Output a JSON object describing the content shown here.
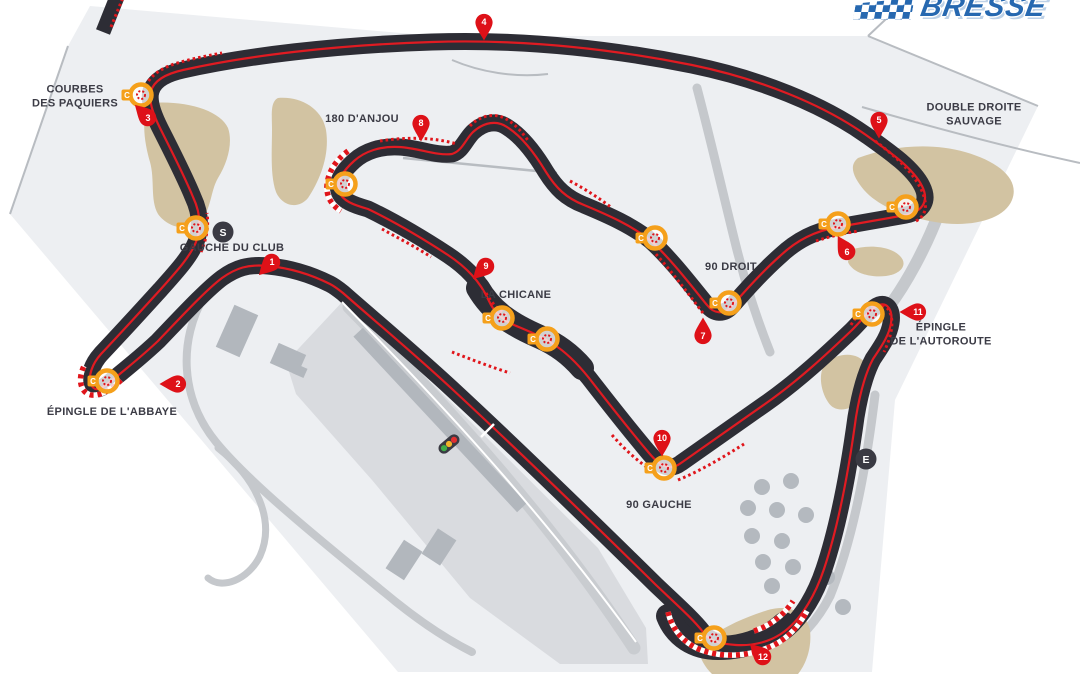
{
  "logo": {
    "text": "BRESSE",
    "color": "#2668b0"
  },
  "map": {
    "colors": {
      "panel": "#edeff2",
      "paddock": "#d9dbdf",
      "pitlane": "#c9ccd0",
      "road": "#c5c8cc",
      "thin_line": "#b8bcc1",
      "building": "#b2b7bd",
      "gravel": "#d2c3a2",
      "tree": "#b4b9bf",
      "track": "#2d2d35",
      "race_line": "#e01b22",
      "kerb_red": "#e0151b",
      "pin_red": "#de1118",
      "corner_orange": "#f5a01b",
      "marker_dark": "#3a3a43",
      "label": "#3b3b45",
      "white": "#ffffff"
    },
    "panel": {
      "points": "90,6 435,36 868,36 1038,106 895,400 872,672 398,672 10,214 68,46"
    },
    "boundary_lines": [
      {
        "d": "M868,36 L1038,106"
      },
      {
        "d": "M903,3 L868,36"
      },
      {
        "d": "M68,46 L10,214"
      },
      {
        "d": "M862,107 C935,128 1010,148 1080,163"
      },
      {
        "d": "M452,60 C480,72 515,78 548,74"
      }
    ],
    "areas": [
      {
        "points": "286,362 344,300 374,326 598,548 646,628 648,664 560,664 470,598 372,480 296,394"
      }
    ],
    "roads": [
      {
        "d": "M205,295 C178,340 180,398 216,442 C252,486 330,548 396,602 C426,626 452,642 472,652",
        "w": 8
      },
      {
        "d": "M218,448 C256,478 276,520 260,556 C248,580 222,590 208,578",
        "w": 7
      },
      {
        "d": "M697,88 C712,145 724,198 736,246 C746,286 758,322 770,352",
        "w": 9
      },
      {
        "d": "M940,210 C926,248 906,284 888,308",
        "w": 12
      },
      {
        "d": "M875,395 C868,452 856,532 830,596 C818,620 800,640 778,653",
        "w": 9
      }
    ],
    "pit_lane": {
      "d": "M349,307 C430,390 540,505 634,648",
      "w": 13
    },
    "pit_wall": {
      "d": "M342,302 C420,382 532,498 636,642",
      "w": 2
    },
    "buildings": [
      {
        "x": 237,
        "y": 331,
        "w": 26,
        "h": 46,
        "rot": 24
      },
      {
        "x": 288,
        "y": 359,
        "w": 30,
        "h": 22,
        "rot": 24
      },
      {
        "x": 300,
        "y": 371,
        "w": 12,
        "h": 10,
        "rot": 24
      },
      {
        "x": 404,
        "y": 560,
        "w": 22,
        "h": 34,
        "rot": 33
      },
      {
        "x": 439,
        "y": 547,
        "w": 22,
        "h": 30,
        "rot": 33
      },
      {
        "x": 440,
        "y": 420,
        "w": 240,
        "h": 13,
        "rot": 47
      }
    ],
    "gravel": [
      {
        "d": "M150,103 C185,100 220,110 228,128 C233,142 228,162 218,178 C210,192 212,208 200,222 C188,232 168,228 158,214 C150,200 155,180 150,162 C145,145 140,118 150,103 Z"
      },
      {
        "d": "M278,98 C300,96 322,108 326,130 C330,155 320,180 308,198 C298,210 282,206 276,192 C270,175 272,150 272,130 C272,115 270,102 278,98 Z"
      },
      {
        "d": "M858,158 C890,146 930,142 965,152 C1000,162 1020,180 1012,200 C1004,220 970,228 935,222 C905,217 878,206 864,190 C854,178 848,166 858,158 Z"
      },
      {
        "d": "M850,250 C868,244 890,246 900,256 C908,264 902,274 886,276 C868,278 852,272 848,262 Z"
      },
      {
        "d": "M826,362 C840,352 858,352 866,364 C872,374 868,390 858,402 C848,412 834,412 828,402 C820,390 818,372 826,362 Z"
      },
      {
        "d": "M700,646 C716,630 742,618 768,610 C790,604 806,612 810,630 C812,648 806,664 798,674 L712,674 C704,666 698,656 700,646 Z"
      }
    ],
    "trees": [
      {
        "x": 762,
        "y": 487
      },
      {
        "x": 791,
        "y": 481
      },
      {
        "x": 748,
        "y": 508
      },
      {
        "x": 777,
        "y": 510
      },
      {
        "x": 806,
        "y": 515
      },
      {
        "x": 752,
        "y": 536
      },
      {
        "x": 782,
        "y": 541
      },
      {
        "x": 763,
        "y": 562
      },
      {
        "x": 793,
        "y": 567
      },
      {
        "x": 772,
        "y": 586
      },
      {
        "x": 827,
        "y": 577
      },
      {
        "x": 843,
        "y": 607
      }
    ],
    "bypass": {
      "d": "M403,158 C455,163 510,168 557,173"
    },
    "stub": {
      "d": "M103,32 L119,-8"
    },
    "track": {
      "w": 17,
      "d": "M330,284 C310,274 290,268 268,266 C248,264 236,268 222,278 C206,290 182,316 158,341 C140,358 122,372 110,382 C100,390 94,392 91,384 C88,376 92,364 101,354 C118,336 140,312 160,290 C176,272 190,257 196,242 C201,229 201,214 193,197 C184,175 170,148 160,128 C154,116 148,101 151,91 C154,81 165,74 183,70 C245,56 335,45 432,42 C522,39 612,49 692,65 C760,79 822,104 866,135 C890,152 913,168 922,186 C929,200 924,211 906,215 C884,219 860,223 838,227 C815,231 797,240 780,256 C762,272 744,292 732,306 C724,315 714,314 707,305 C693,288 671,259 651,241 C633,226 608,215 584,205 C566,198 556,188 546,172 C537,157 523,137 507,127 C497,120 484,122 473,132 C465,140 462,151 452,154 C436,156 419,148 399,147 C381,146 365,151 354,161 C343,171 336,181 339,191 C342,201 354,205 368,209 C393,221 422,238 448,255 C466,267 480,281 489,301 C494,312 503,320 514,325 C528,331 541,336 553,344 C566,352 577,363 589,378 C606,400 628,428 649,453 C659,465 669,472 681,463 C701,449 732,427 765,404 C798,381 829,352 852,330 C862,320 871,308 879,305 C888,302 893,311 891,323 C889,336 881,347 873,359 C866,372 860,393 856,417 C850,461 840,521 824,569 C816,593 803,617 785,631 C771,642 753,646 736,645 C721,644 709,641 703,632 C693,619 676,604 656,585 C598,528 519,451 451,388 C411,351 369,316 343,293 C338,289 334,286 330,284 Z",
      "widen": [
        "M478,288 C492,312 512,325 540,337 C556,344 570,354 582,368",
        "M668,616 C676,636 694,648 718,648 C744,648 766,640 784,624"
      ]
    },
    "kerbs": [
      {
        "d": "M146,86 C150,76 160,69 174,64 C190,59 206,56 222,53",
        "striped": false
      },
      {
        "d": "M201,252 C206,240 209,228 207,213",
        "striped": false
      },
      {
        "d": "M121,380 C110,391 97,398 88,394 C80,390 78,378 84,366",
        "striped": true
      },
      {
        "d": "M348,151 C336,160 328,172 327,185 C326,196 331,205 341,211",
        "striped": true
      },
      {
        "d": "M380,141 C405,137 433,137 457,144",
        "striped": false
      },
      {
        "d": "M470,126 C479,116 494,112 506,119 C515,124 523,133 529,142",
        "striped": false
      },
      {
        "d": "M570,181 C585,189 599,198 612,208",
        "striped": false
      },
      {
        "d": "M703,313 C690,296 673,273 655,253",
        "striped": false
      },
      {
        "d": "M382,229 C398,238 416,247 431,257",
        "striped": false
      },
      {
        "d": "M452,352 C470,359 491,367 510,373",
        "striped": false
      },
      {
        "d": "M486,293 C492,304 500,312 511,317",
        "striped": false
      },
      {
        "d": "M612,435 C625,450 639,462 652,471",
        "striped": false
      },
      {
        "d": "M678,480 C700,471 722,458 744,444",
        "striped": false
      },
      {
        "d": "M851,325 C861,308 877,299 888,309 C895,319 892,335 884,352",
        "striped": false
      },
      {
        "d": "M875,141 C894,155 912,171 921,189 C928,204 927,215 916,221",
        "striped": false
      },
      {
        "d": "M816,241 C831,236 845,233 859,231",
        "striped": false
      },
      {
        "d": "M668,612 C672,630 685,645 704,651 C726,658 750,656 772,646 C787,639 799,626 807,611",
        "striped": true
      },
      {
        "d": "M754,631 C770,626 784,615 793,601",
        "striped": true
      },
      {
        "d": "M111,27 L124,-5",
        "striped": false
      }
    ],
    "start_line": {
      "d": "M481,437 L494,424"
    },
    "start_light": {
      "x": 449,
      "y": 444,
      "rot": -40
    },
    "corner_markers": [
      {
        "x": 196,
        "y": 228
      },
      {
        "x": 107,
        "y": 381
      },
      {
        "x": 141,
        "y": 95
      },
      {
        "x": 345,
        "y": 184
      },
      {
        "x": 502,
        "y": 318
      },
      {
        "x": 547,
        "y": 339
      },
      {
        "x": 655,
        "y": 238
      },
      {
        "x": 729,
        "y": 303
      },
      {
        "x": 838,
        "y": 224
      },
      {
        "x": 906,
        "y": 207
      },
      {
        "x": 872,
        "y": 314
      },
      {
        "x": 664,
        "y": 468
      },
      {
        "x": 714,
        "y": 638
      }
    ],
    "corner_tab_letter": "C",
    "pin_markers": [
      {
        "n": "1",
        "x": 272,
        "y": 262,
        "rot": 45
      },
      {
        "n": "2",
        "x": 178,
        "y": 384,
        "rot": 90
      },
      {
        "n": "3",
        "x": 148,
        "y": 118,
        "rot": 135
      },
      {
        "n": "4",
        "x": 484,
        "y": 22,
        "rot": 0
      },
      {
        "n": "5",
        "x": 879,
        "y": 120,
        "rot": 0
      },
      {
        "n": "6",
        "x": 847,
        "y": 252,
        "rot": 150
      },
      {
        "n": "7",
        "x": 703,
        "y": 336,
        "rot": 180
      },
      {
        "n": "8",
        "x": 421,
        "y": 123,
        "rot": 0
      },
      {
        "n": "9",
        "x": 486,
        "y": 266,
        "rot": 45
      },
      {
        "n": "10",
        "x": 662,
        "y": 438,
        "rot": 0
      },
      {
        "n": "11",
        "x": 918,
        "y": 312,
        "rot": 90
      },
      {
        "n": "12",
        "x": 763,
        "y": 657,
        "rot": 135
      }
    ],
    "point_markers": [
      {
        "t": "S",
        "x": 223,
        "y": 232
      },
      {
        "t": "E",
        "x": 866,
        "y": 459
      }
    ],
    "labels": [
      {
        "x": 75,
        "y": 97,
        "lines": [
          "COURBES",
          "DES PAQUIERS"
        ]
      },
      {
        "x": 362,
        "y": 119,
        "lines": [
          "180 D'ANJOU"
        ]
      },
      {
        "x": 974,
        "y": 115,
        "lines": [
          "DOUBLE DROITE",
          "SAUVAGE"
        ]
      },
      {
        "x": 232,
        "y": 248,
        "lines": [
          "GAUCHE DU CLUB"
        ]
      },
      {
        "x": 516,
        "y": 295,
        "lines": [
          "LA CHICANE"
        ]
      },
      {
        "x": 731,
        "y": 267,
        "lines": [
          "90 DROIT"
        ]
      },
      {
        "x": 112,
        "y": 412,
        "lines": [
          "ÉPINGLE DE L'ABBAYE"
        ]
      },
      {
        "x": 941,
        "y": 335,
        "lines": [
          "ÉPINGLE",
          "DE L'AUTOROUTE"
        ]
      },
      {
        "x": 659,
        "y": 505,
        "lines": [
          "90 GAUCHE"
        ]
      }
    ]
  }
}
